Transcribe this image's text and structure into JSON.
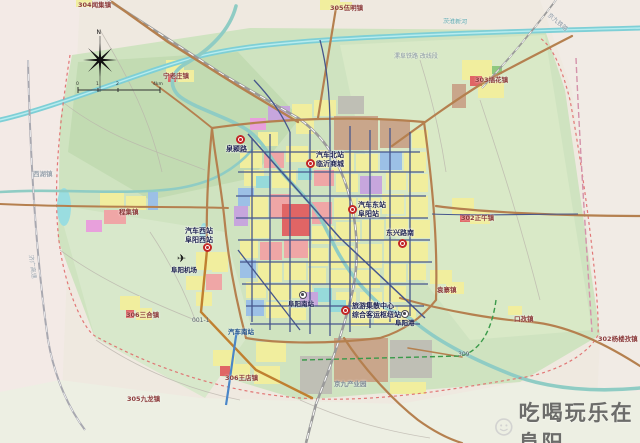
{
  "watermark": {
    "text": "吃喝玩乐在阜阳"
  },
  "compass": {
    "north_label": "N"
  },
  "scale_bar": {
    "labels": [
      "0",
      "1",
      "2",
      "4km"
    ]
  },
  "map": {
    "colors": {
      "station_marker": "#c22525",
      "town_text": "#8b3a3a",
      "station_text": "#1c2050",
      "major_road": "#b5804f",
      "urban_grid": "#46568c",
      "water": "#7ecfd6",
      "boundary": "#e06a6a"
    },
    "stations": [
      {
        "id": "quan-ying-lu",
        "x": 240,
        "y": 139,
        "lx": -14,
        "ly": 6,
        "lines": [
          "泉颍路"
        ]
      },
      {
        "id": "qiche-beizhan",
        "x": 310,
        "y": 163,
        "lx": 6,
        "ly": -12,
        "lines": [
          "汽车北站",
          "临沂商城"
        ]
      },
      {
        "id": "qiche-dongzhan",
        "x": 352,
        "y": 209,
        "lx": 6,
        "ly": -8,
        "lines": [
          "汽车东站",
          "阜阳站"
        ]
      },
      {
        "id": "dongxing-lu-nan",
        "x": 402,
        "y": 243,
        "lx": -16,
        "ly": -14,
        "lines": [
          "东兴路南"
        ]
      },
      {
        "id": "qiche-xizhan",
        "x": 207,
        "y": 247,
        "lx": -22,
        "ly": -20,
        "lines": [
          "汽车西站",
          "阜阳西站"
        ]
      },
      {
        "id": "south-hub",
        "x": 345,
        "y": 310,
        "lx": 7,
        "ly": -8,
        "lines": [
          "旅游集散中心",
          "综合客运枢纽站"
        ]
      }
    ],
    "pois": [
      {
        "id": "airport",
        "icon": "plane",
        "glyph": "✈",
        "x": 183,
        "y": 260,
        "lx": -12,
        "ly": 7,
        "label": "阜阳机场"
      },
      {
        "id": "fuyang-south-rail",
        "icon": "circle-dot",
        "glyph": "",
        "x": 303,
        "y": 295,
        "lx": -15,
        "ly": 6,
        "label": "阜阳南站"
      },
      {
        "id": "fuyang-port",
        "icon": "circle-dot",
        "glyph": "",
        "x": 405,
        "y": 314,
        "lx": -10,
        "ly": 6,
        "label": "阜阳港"
      }
    ],
    "towns": [
      {
        "text": "304闻集镇",
        "x": 78,
        "y": 2
      },
      {
        "text": "305伍明镇",
        "x": 330,
        "y": 5
      },
      {
        "text": "宁老庄镇",
        "x": 163,
        "y": 73
      },
      {
        "text": "303插花镇",
        "x": 475,
        "y": 77
      },
      {
        "text": "302正午镇",
        "x": 461,
        "y": 215
      },
      {
        "text": "袁寨镇",
        "x": 437,
        "y": 287
      },
      {
        "text": "程集镇",
        "x": 119,
        "y": 209
      },
      {
        "text": "西湖镇",
        "x": 33,
        "y": 171,
        "color": "#9aa4ae"
      },
      {
        "text": "306三合镇",
        "x": 126,
        "y": 312
      },
      {
        "text": "306王店镇",
        "x": 225,
        "y": 375
      },
      {
        "text": "305九龙镇",
        "x": 127,
        "y": 396
      },
      {
        "text": "口孜镇",
        "x": 514,
        "y": 316
      },
      {
        "text": "302杨楼孜镇",
        "x": 598,
        "y": 336
      },
      {
        "text": "汽车南站",
        "x": 228,
        "y": 329,
        "color": "#1d4f8a"
      },
      {
        "text": "京九产业园",
        "x": 334,
        "y": 381,
        "color": "#7c8894"
      }
    ],
    "road_labels": [
      {
        "text": "漯阜铁路 改线段",
        "x": 394,
        "y": 54,
        "rotate": 0,
        "color": "#8a97a4"
      },
      {
        "text": "茨淮新河",
        "x": 443,
        "y": 19,
        "rotate": 2,
        "color": "#5aa8b0"
      },
      {
        "text": "京九铁路",
        "x": 548,
        "y": 12,
        "rotate": 40,
        "color": "#8a97a4"
      },
      {
        "text": "济广高速",
        "x": 30,
        "y": 252,
        "rotate": 82,
        "color": "#9aa4ae"
      },
      {
        "text": "001-1",
        "x": 192,
        "y": 318,
        "rotate": 0,
        "color": "#55606a"
      },
      {
        "text": "309",
        "x": 458,
        "y": 352,
        "rotate": 0,
        "color": "#55606a"
      }
    ]
  }
}
